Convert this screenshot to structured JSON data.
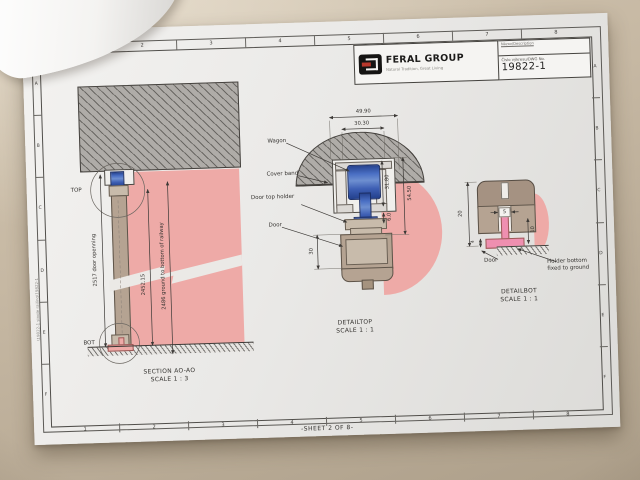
{
  "sheet": {
    "footer": "-SHEET 2 OF 8-",
    "file_path": "\\19822-1 single railing\\19822-1",
    "border": {
      "columns": [
        "1",
        "2",
        "3",
        "4",
        "5",
        "6",
        "7",
        "8"
      ],
      "rows": [
        "A",
        "B",
        "C",
        "D",
        "E",
        "F"
      ]
    }
  },
  "title_block": {
    "brand": "FERAL GROUP",
    "tagline": "Natural Tradition, Great Living",
    "name_label": "Názov/Description",
    "dwg_label": "Číslo výkresu/DWG No.",
    "dwg_no": "19822-1"
  },
  "section": {
    "title": "SECTION AO-AO",
    "scale": "SCALE 1 : 3",
    "top_label": "TOP",
    "bottom_label": "BOT",
    "dim_door_opening": "2517 door openning",
    "dim_rail": "2452.15",
    "dim_ground": "2486 ground to bottom of railway"
  },
  "detail_top": {
    "title": "DETAILTOP",
    "scale": "SCALE 1 : 1",
    "label_wagon": "Wagon",
    "label_cover_band": "Cover band",
    "label_door_top_holder": "Door top holder",
    "label_door": "Door",
    "dim_width_outer": "49.90",
    "dim_width_inner": "30.30",
    "dim_rail_height": "31.80",
    "dim_gap": "6.0",
    "dim_total_height": "54.50",
    "dim_door_thickness": "30"
  },
  "detail_bot": {
    "title": "DETAILBOT",
    "scale": "SCALE 1 : 1",
    "label_door": "Door",
    "label_holder_line1": "Holder bottom",
    "label_holder_line2": "fixed to ground",
    "dim_height": "20",
    "dim_offset": "4",
    "dim_slot": "5",
    "dim_side": "10"
  }
}
